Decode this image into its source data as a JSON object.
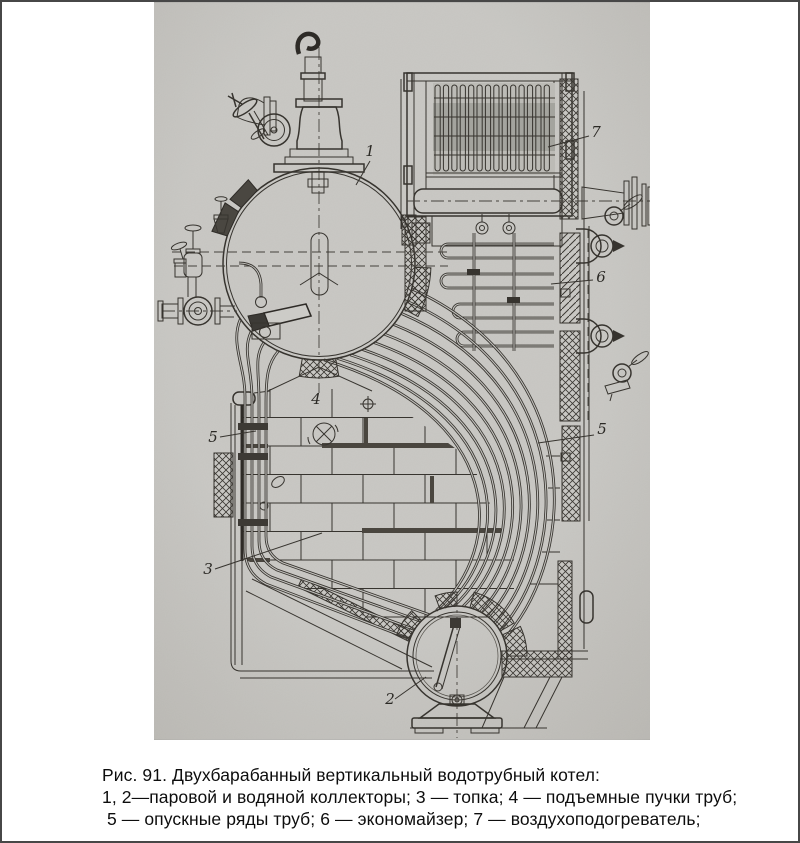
{
  "figure": {
    "title_semantic": "Two-drum vertical water-tube boiler technical drawing",
    "number_labels": {
      "upper_drum": "1",
      "lower_drum": "2",
      "furnace": "3",
      "riser_tubes": "4",
      "downcomers_left": "5",
      "downcomers_right": "5",
      "economizer": "6",
      "air_preheater": "7"
    }
  },
  "caption": {
    "line1": "Рис. 91. Двухбарабанный вертикальный водотрубный котел:",
    "line2": "1, 2—паровой и водяной коллекторы; 3 — топка; 4 — подъемные пучки труб;",
    "line3": " 5 — опускные ряды труб; 6 — экономайзер; 7 — воздухоподогреватель;"
  },
  "colors": {
    "page_bg": "#ffffff",
    "frame": "#474747",
    "scan_paper": "#c6c5c1",
    "ink": "#37342f",
    "caption_text": "#0d0d0d"
  }
}
